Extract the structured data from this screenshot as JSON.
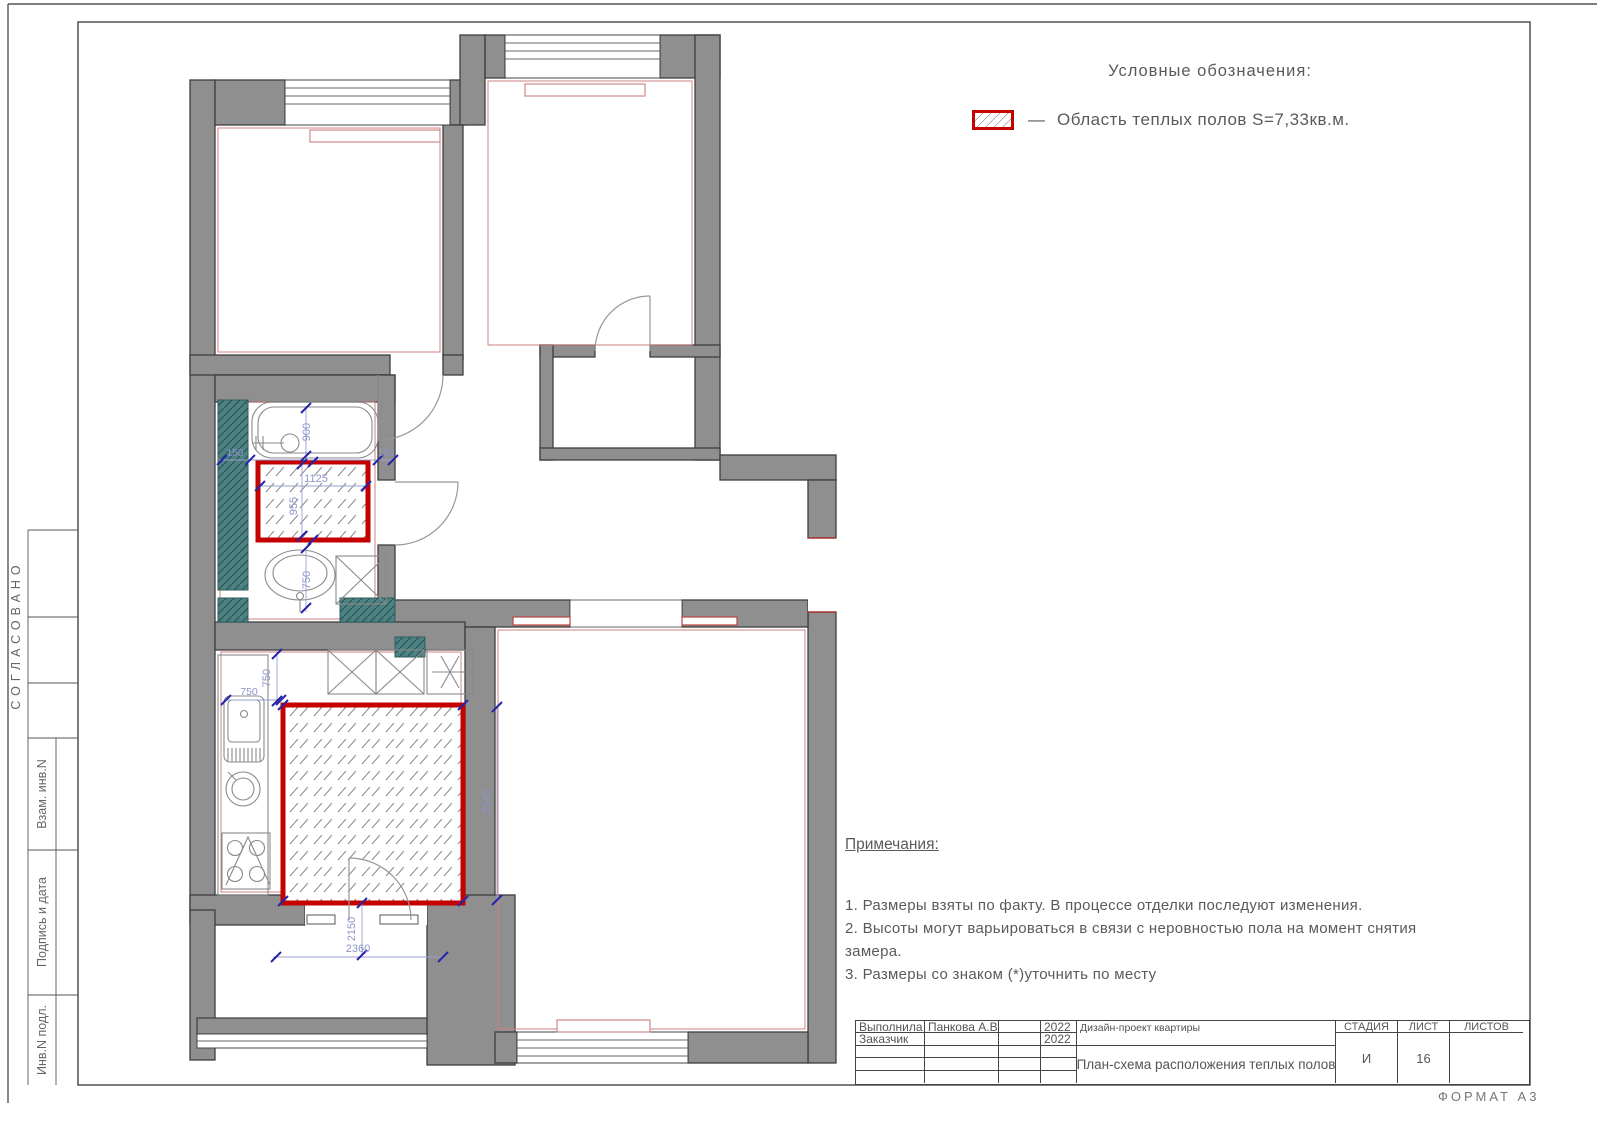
{
  "sheet": {
    "format": "ФОРМАТ А3"
  },
  "legend": {
    "title": "Условные обозначения:",
    "dash": "—",
    "label": "Область теплых полов S=7,33кв.м."
  },
  "notes": {
    "title": "Примечания:",
    "items": [
      "1.  Размеры взяты по факту.  В процессе отделки последуют изменения.",
      "2.  Высоты могут варьироваться в связи с неровностью пола на момент снятия замера.",
      "3.  Размеры со знаком (*)уточнить   по месту"
    ]
  },
  "stamp": {
    "performed_label": "Выполнила",
    "performed_name": "Панкова А.В.",
    "performed_year": "2022",
    "customer_label": "Заказчик",
    "customer_year": "2022",
    "project": "Дизайн-проект квартиры",
    "drawing_title": "План-схема расположения теплых полов",
    "stage_label": "СТАДИЯ",
    "sheet_label": "ЛИСТ",
    "sheets_label": "ЛИСТОВ",
    "stage_value": "И",
    "sheet_value": "16",
    "sheets_value": ""
  },
  "side_frame": {
    "approved": "СОГЛАСОВАНО",
    "vzam": "Взам. инв.N",
    "podpis": "Подпись и дата",
    "inv": "Инв.N подл."
  },
  "plan": {
    "warm_floor_area_label": "S=7,33кв.м.",
    "dims": {
      "bath_150_left": "150",
      "bath_900": "900",
      "bath_150_right": "150",
      "wf_1125": "1125",
      "wf_955": "955",
      "sink_750": "750",
      "kitchen_750_v": "750",
      "kitchen_750_h": "750",
      "kitchen_2545": "2545",
      "kitchen_2150": "2150",
      "kitchen_2360": "2360"
    }
  },
  "colors": {
    "wall": "#8f8f8f",
    "teal_wall": "#4e8282",
    "warm_floor_border": "#c40000",
    "dimension": "#8e94c8",
    "tick_blue": "#2525a8",
    "radiator_red": "#cf8888"
  }
}
